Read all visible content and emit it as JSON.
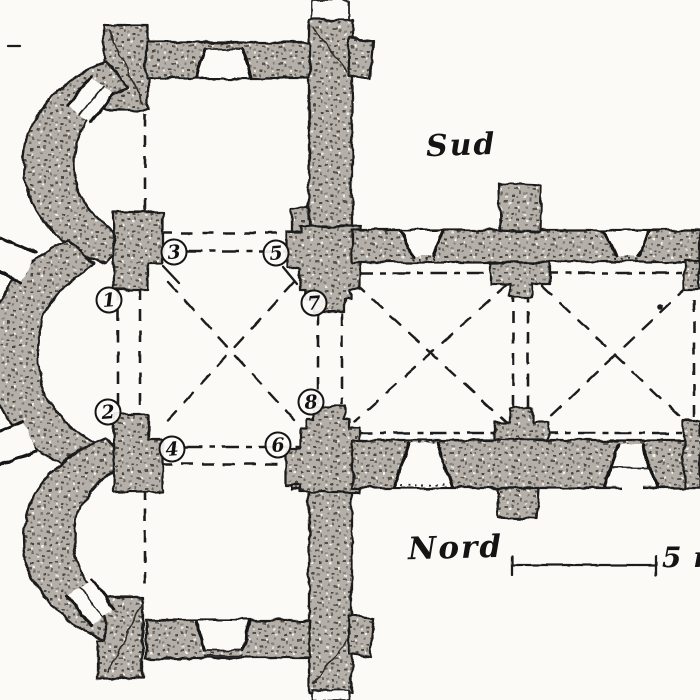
{
  "plan": {
    "compass_labels": {
      "south": "Sud",
      "north": "Nord"
    },
    "scale_bar": {
      "label": "5 m"
    },
    "pier_markers": [
      {
        "n": "1",
        "x": 109,
        "y": 300
      },
      {
        "n": "2",
        "x": 108,
        "y": 412
      },
      {
        "n": "3",
        "x": 174,
        "y": 252
      },
      {
        "n": "4",
        "x": 172,
        "y": 449
      },
      {
        "n": "5",
        "x": 276,
        "y": 253
      },
      {
        "n": "6",
        "x": 278,
        "y": 445
      },
      {
        "n": "7",
        "x": 314,
        "y": 303
      },
      {
        "n": "8",
        "x": 311,
        "y": 402
      }
    ],
    "colors": {
      "paper": "#fbfaf7",
      "ink": "#1b1b1b",
      "wall_base": "#b4afa8"
    }
  }
}
